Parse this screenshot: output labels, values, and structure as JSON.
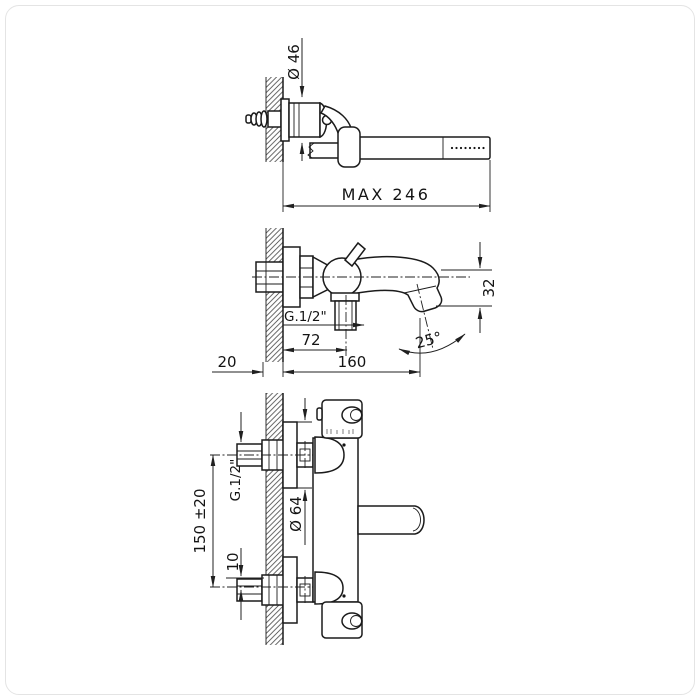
{
  "image": {
    "background": "#ffffff",
    "line_color": "#1b1b1b",
    "frame_color": "#e4e4e4"
  },
  "drawings": {
    "hand_shower": {
      "dims": {
        "bracket_diameter": "Ø 46",
        "max_length": "MAX 246"
      }
    },
    "bath_mixer": {
      "dims": {
        "outlet_thread": "G.1/2\"",
        "spout_center": "72",
        "reach": "160",
        "wall": "20",
        "drop": "32",
        "angle": "25°"
      }
    },
    "thermostatic": {
      "dims": {
        "inlet_centers": "150 ±20",
        "inlet_thread": "G.1/2\"",
        "flange_diameter": "Ø 64",
        "offset": "10"
      }
    }
  }
}
